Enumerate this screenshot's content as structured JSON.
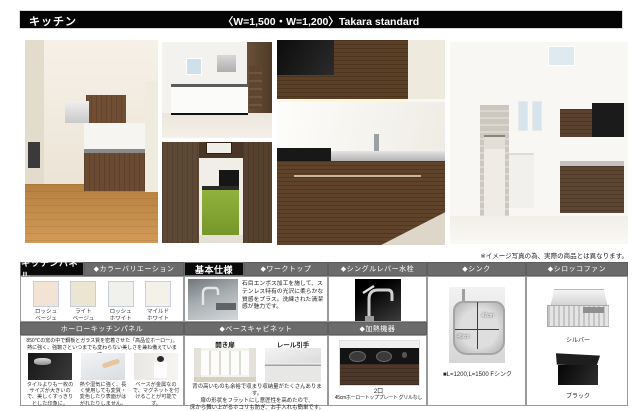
{
  "window": {
    "title": "キッチン",
    "subtitle": "〈W=1,500・W=1,200〉Takara standard"
  },
  "note": "※イメージ写真の為、実際の商品とは異なります。",
  "colors": {
    "bar_black": "#050505",
    "header_gray": "#6b6b6b",
    "dimension_red": "#cc0000"
  },
  "panel": {
    "title": "キッチンパネル",
    "variation_header": "◆カラーバリエーション",
    "swatches": [
      {
        "line1": "ロッシュ",
        "line2": "ベージュ",
        "color": "#f2e3d5"
      },
      {
        "line1": "ライト",
        "line2": "ベージュ",
        "color": "#ece5d2"
      },
      {
        "line1": "ロッシュ",
        "line2": "ホワイト",
        "color": "#f0f1ec"
      },
      {
        "line1": "マイルド",
        "line2": "ホワイト",
        "color": "#f3f1e8"
      }
    ],
    "enamel_header": "ホーローキッチンパネル",
    "enamel_desc": "850℃の窯の中で鋼板とガラス質を密着させた「高品位ホーロー」。\n熱に強く、強靭さといつまでも変わらない美しさを兼ね備えています。",
    "features": [
      {
        "caption": "タイルよりも一枚のサイズが大きいので、美しくすっきりとした印象に。"
      },
      {
        "caption": "熱や湿気に強く、長く使用しても変質・変色したり表面がはがれたりしません。"
      },
      {
        "caption": "ベースが金属なので、マグネットを付けることが可能です。"
      }
    ]
  },
  "spec": {
    "title": "基本仕様",
    "worktop_header": "◆ワークトップ",
    "worktop_desc": "石目エンボス加工を施して、ステンレス特有の光沢に柔らかな質感をプラス。洗練された清潔感が魅力です。",
    "cabinet_header": "◆ベースキャビネット",
    "door_label": "開き扉",
    "rail_label": "レール引手",
    "cabinet_desc": "背の高いものも余裕で収まり収納量がたくさんあります。\n扉の形状をフラットにし意匠性を高めたので、\n床から舞い上がるホコリも防ぎ、お手入れも簡単です。"
  },
  "faucet": {
    "header": "◆シングルレバー水栓"
  },
  "heater": {
    "header": "◆加熱機器",
    "burners": "2口",
    "spec": "45cmホーロートッププレート グリルなし"
  },
  "sink": {
    "header": "◆シンク",
    "width_label": "47cm",
    "depth_label": "45cm",
    "caption": "■L=1200,L=1500 Fシンク"
  },
  "fan": {
    "header": "◆シロッコファン",
    "silver_label": "シルバー",
    "black_label": "ブラック"
  }
}
